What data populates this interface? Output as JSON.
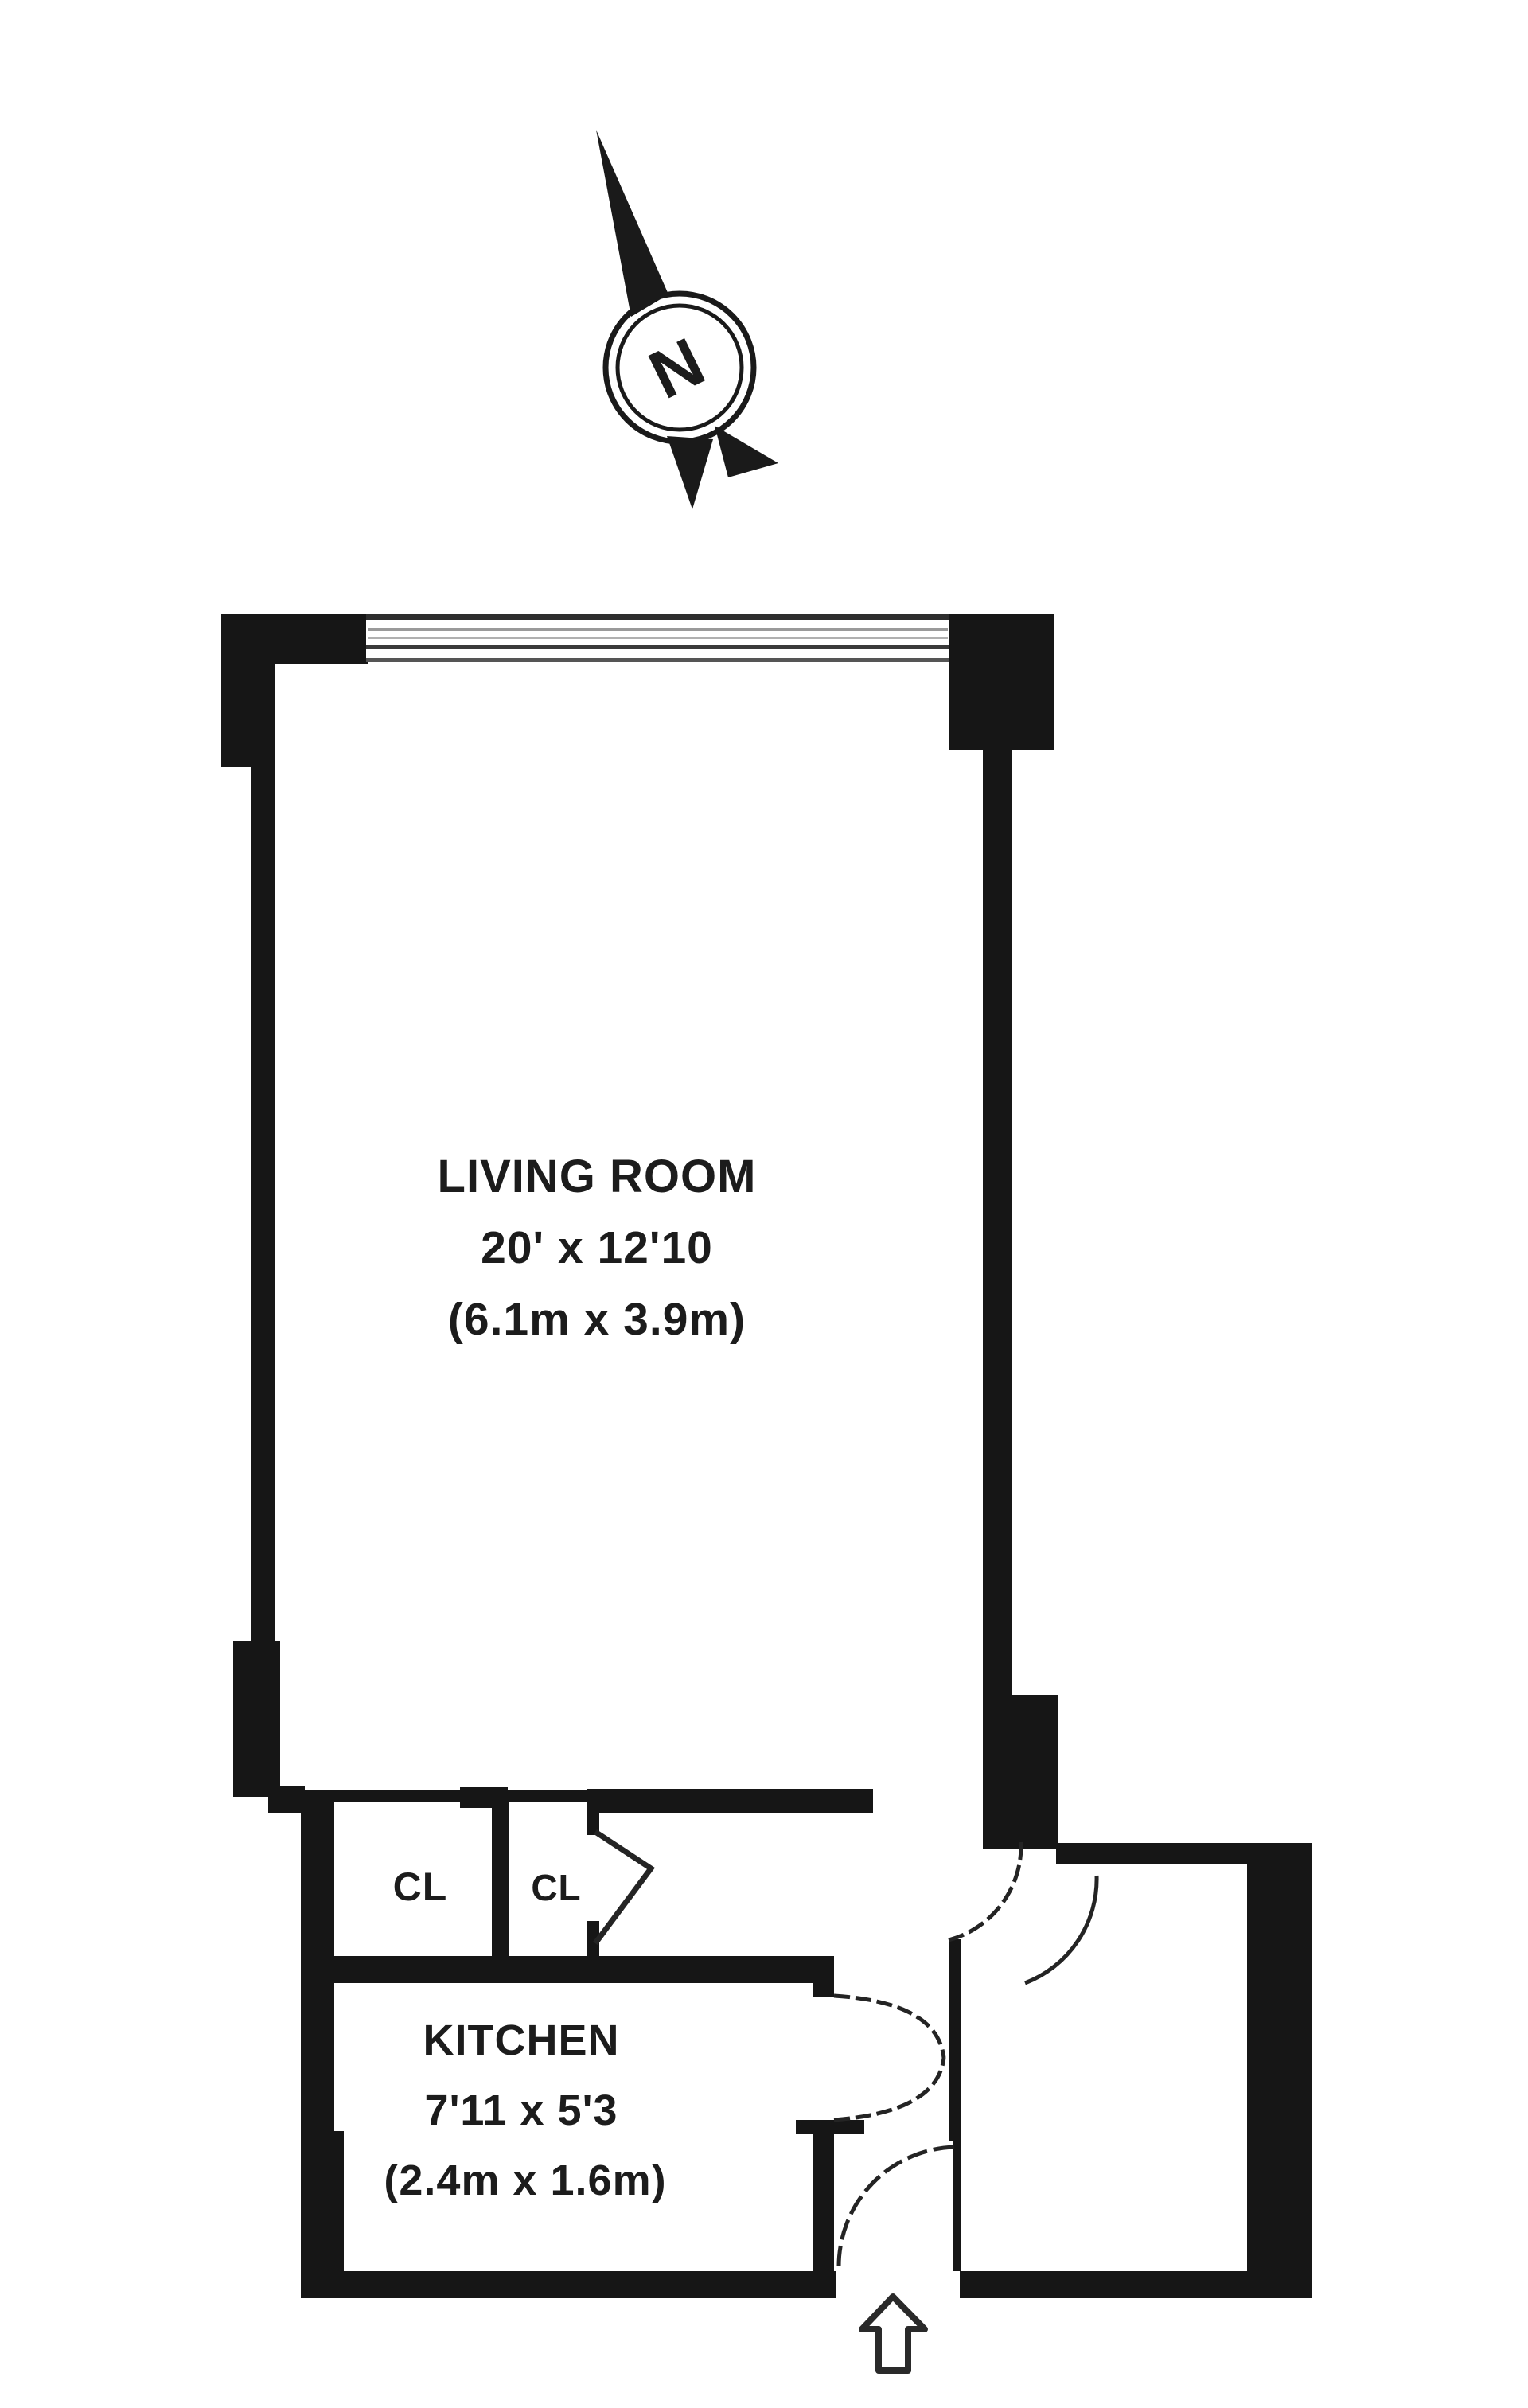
{
  "compass": {
    "label": "N"
  },
  "rooms": {
    "living_room": {
      "name": "LIVING ROOM",
      "size_imperial": "20' x 12'10",
      "size_metric": "(6.1m x 3.9m)"
    },
    "kitchen": {
      "name": "KITCHEN",
      "size_imperial": "7'11 x 5'3",
      "size_metric": "(2.4m x 1.6m)"
    },
    "closet_left": {
      "abbr": "CL"
    },
    "closet_right": {
      "abbr": "CL"
    }
  },
  "colors": {
    "wall": "#161616",
    "text": "#1c1c1c",
    "window_line_dark": "#3a3a3a",
    "window_line_light": "#9a9a9a",
    "background": "#ffffff"
  }
}
